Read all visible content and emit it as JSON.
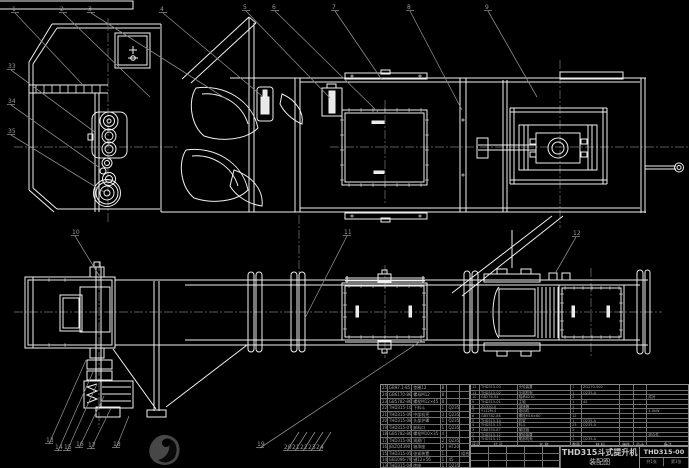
{
  "drawing": {
    "title": "THD315斗式提升机",
    "subtitle": "装配图",
    "drawing_number": "THD315-00",
    "sheet_count": "共1张",
    "sheet_number": "第1张"
  },
  "colors": {
    "background": "#000000",
    "main_line": "#f0f0f0",
    "leader_line": "#8a8a8a",
    "centerline": "#787878",
    "table_line": "#8c8c8c",
    "table_text": "#a9a9a9"
  },
  "callouts": {
    "top": [
      "1",
      "2",
      "3",
      "4",
      "5",
      "6",
      "7",
      "8",
      "9"
    ],
    "left": [
      "33",
      "34",
      "35"
    ],
    "mid": [
      "10",
      "11",
      "12"
    ],
    "bottom": [
      "13",
      "14",
      "15",
      "16",
      "17",
      "18",
      "19",
      "20",
      "21",
      "22",
      "23",
      "24"
    ]
  },
  "bom_left": {
    "rows": [
      [
        "25",
        "GB97.1-85",
        "垫圈12",
        "8",
        "",
        ""
      ],
      [
        "24",
        "GB6170-86",
        "螺母M12",
        "8",
        "",
        ""
      ],
      [
        "23",
        "GB5782-86",
        "螺栓M12×45",
        "8",
        "",
        ""
      ],
      [
        "22",
        "THD315-10",
        "下料斗",
        "1",
        "Q235-A",
        ""
      ],
      [
        "21",
        "THD315-09",
        "中部机壳",
        "3",
        "Q235-A",
        ""
      ],
      [
        "20",
        "THD315-08",
        "头部护罩",
        "1",
        "Q235-A",
        ""
      ],
      [
        "19",
        "THD315-07",
        "卸料口",
        "1",
        "Q235-A",
        ""
      ],
      [
        "18",
        "GB5782-86",
        "螺栓M10×35",
        "4",
        "",
        ""
      ],
      [
        "17",
        "THD315-06",
        "观察门",
        "2",
        "Q235-A",
        ""
      ],
      [
        "16",
        "JB/ZQ4390",
        "轴承座",
        "2",
        "HT200",
        ""
      ],
      [
        "15",
        "THD315-05",
        "张紧装置",
        "1",
        "",
        "组合件"
      ],
      [
        "14",
        "GB1096-79",
        "键12×56",
        "1",
        "45",
        ""
      ],
      [
        "13",
        "THD315-04",
        "底座",
        "1",
        "Q235-A",
        ""
      ]
    ]
  },
  "bom_right": {
    "headers": [
      "序号",
      "代 号",
      "名 称",
      "数量",
      "材 料",
      "单件",
      "总计",
      "备注"
    ],
    "rows": [
      [
        "12",
        "THD315-03",
        "头轮装置",
        "1",
        "ZG270-500",
        "",
        "",
        ""
      ],
      [
        "11",
        "THD315-02",
        "头部机壳",
        "1",
        "Q235-A",
        "",
        "",
        ""
      ],
      [
        "10",
        "GB276-94",
        "轴承6210",
        "2",
        "",
        "",
        "",
        "成对"
      ],
      [
        "9",
        "THD315-01",
        "主轴",
        "1",
        "45",
        "",
        "",
        ""
      ],
      [
        "8",
        "ZQ350-Ⅱ",
        "减速器",
        "1",
        "",
        "",
        "",
        ""
      ],
      [
        "7",
        "Y112M-4",
        "电动机",
        "1",
        "",
        "",
        "",
        "4.0kW"
      ],
      [
        "6",
        "GB5782-86",
        "螺栓M16×60",
        "12",
        "",
        "",
        "",
        ""
      ],
      [
        "5",
        "THD315-14",
        "机架",
        "1",
        "Q235-A",
        "",
        "",
        ""
      ],
      [
        "4",
        "THD315-13",
        "料斗",
        "23",
        "Q235-A",
        "",
        "",
        ""
      ],
      [
        "3",
        "GB8350-87",
        "输送链",
        "2",
        "",
        "",
        "",
        ""
      ],
      [
        "2",
        "THD315-12",
        "尾轮装置",
        "1",
        "",
        "",
        "",
        "组合件"
      ],
      [
        "1",
        "THD315-11",
        "尾部机壳",
        "1",
        "Q235-A",
        "",
        "",
        ""
      ]
    ]
  }
}
